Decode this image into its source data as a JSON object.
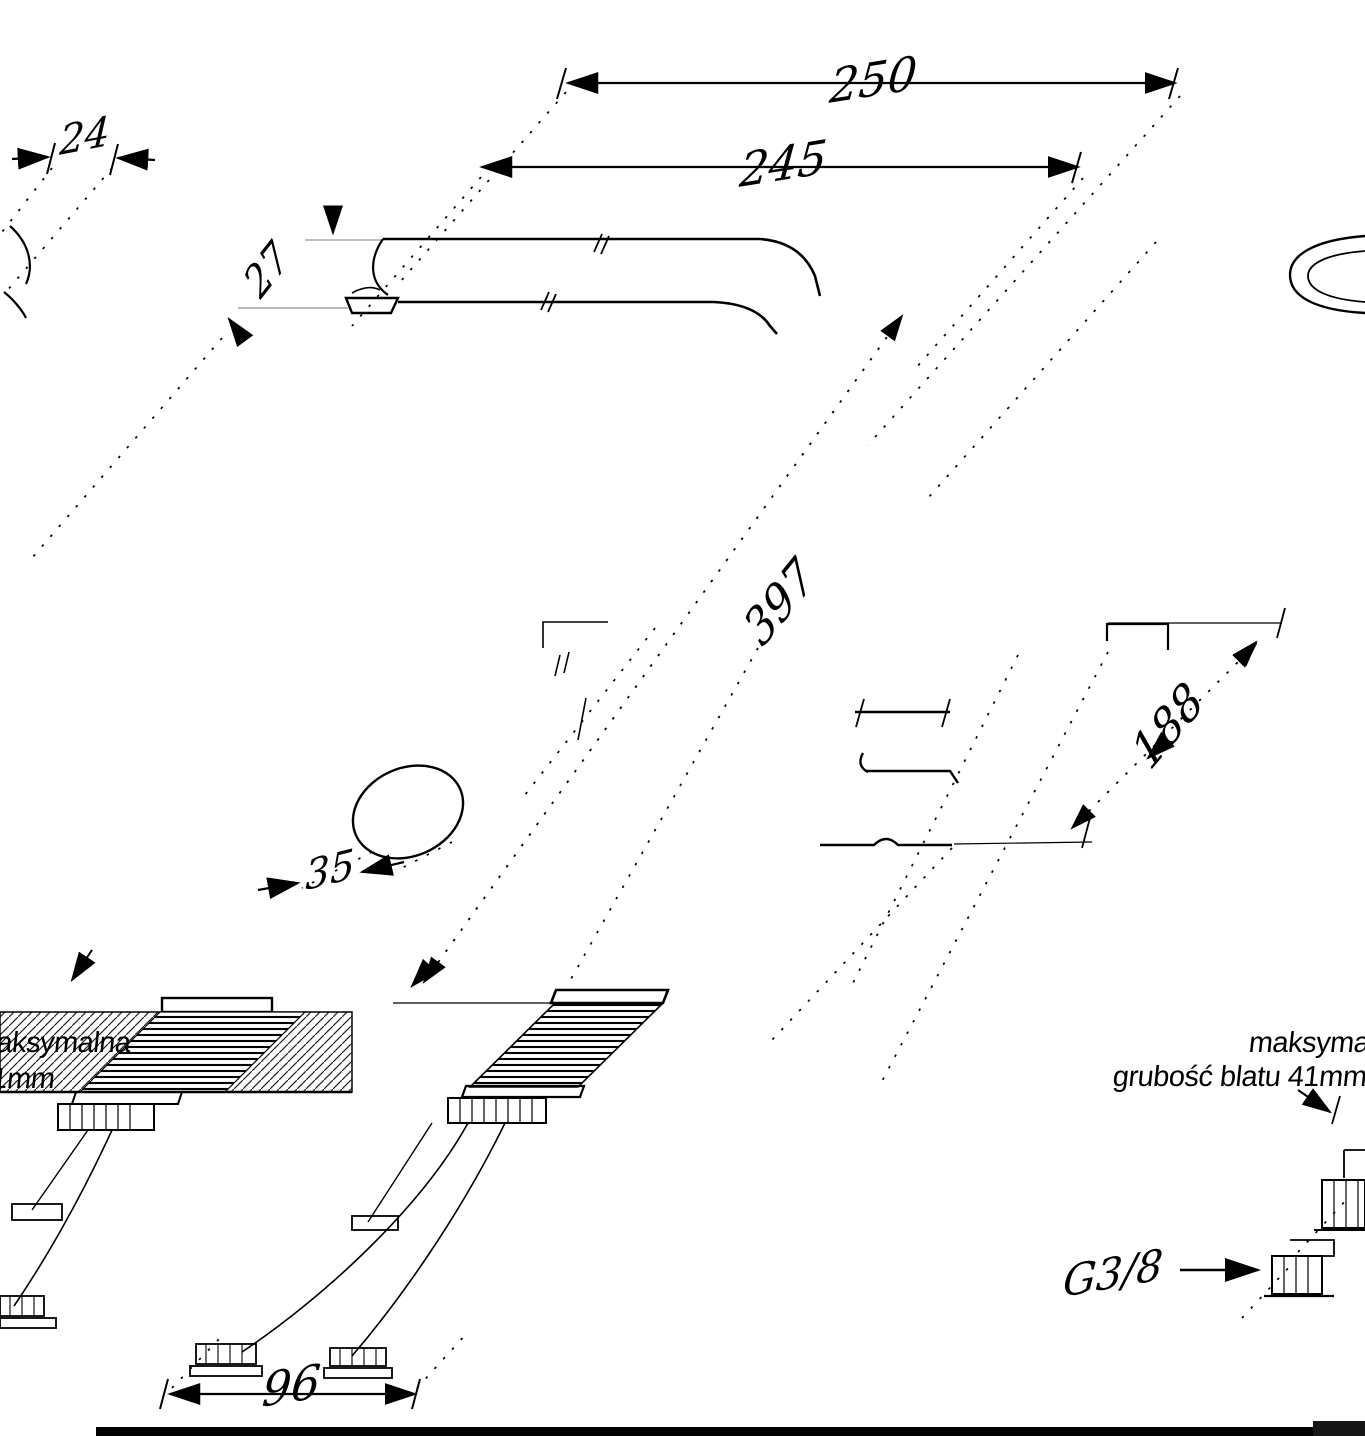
{
  "drawing": {
    "type": "technical dimension drawing of a kitchen faucet (oblique projection)",
    "units": "mm",
    "colors": {
      "line": "#000000",
      "background": "#ffffff"
    },
    "dims": {
      "total_width": "250",
      "spout_reach": "245",
      "head_width": "24",
      "spout_tube_height": "27",
      "total_height": "397",
      "body_height": "188",
      "base_diameter": "35",
      "hose_spread": "96",
      "hose_thread": "G3/8"
    },
    "annotations": {
      "max_worktop_line1": "maksymalna",
      "max_worktop_line2": "grubość blatu 41mm"
    }
  }
}
